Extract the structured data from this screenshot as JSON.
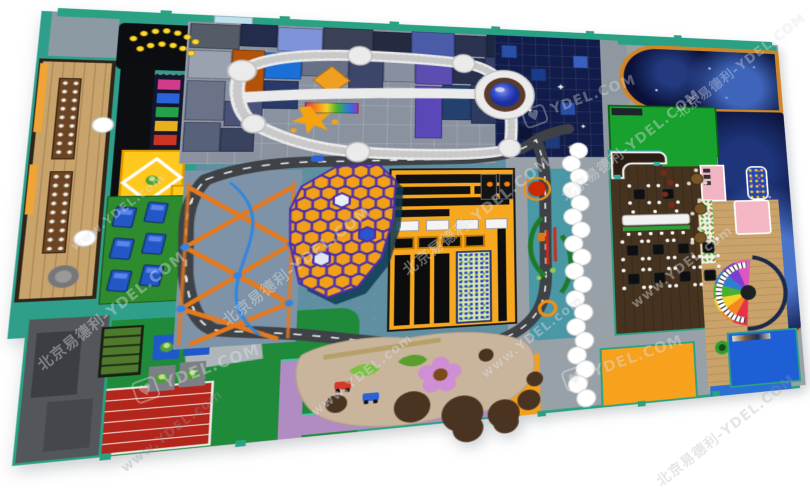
{
  "title": "indoor-playground-floorplan-render",
  "watermark": {
    "brand_cn": "北京易德利",
    "brand_site": "YDEL.COM",
    "brand_url": "www.YDEL.com",
    "combined": "北京易德利-YDEL.COM",
    "heart_glyph": "♥",
    "instances": [
      {
        "kind": "combined",
        "x": 20,
        "y": 300,
        "rot": -38,
        "size": 15,
        "opacity": 0.5,
        "tone": "light"
      },
      {
        "kind": "url",
        "x": 110,
        "y": 424,
        "rot": -38,
        "size": 13,
        "opacity": 0.55,
        "tone": "dark"
      },
      {
        "kind": "url",
        "x": 60,
        "y": 205,
        "rot": -38,
        "size": 12,
        "opacity": 0.45,
        "tone": "light"
      },
      {
        "kind": "combined",
        "x": 205,
        "y": 255,
        "rot": -38,
        "size": 15,
        "opacity": 0.5,
        "tone": "light"
      },
      {
        "kind": "url",
        "x": 300,
        "y": 368,
        "rot": -38,
        "size": 13,
        "opacity": 0.5,
        "tone": "light"
      },
      {
        "kind": "combined",
        "x": 385,
        "y": 205,
        "rot": -38,
        "size": 15,
        "opacity": 0.5,
        "tone": "light"
      },
      {
        "kind": "url",
        "x": 470,
        "y": 330,
        "rot": -38,
        "size": 13,
        "opacity": 0.5,
        "tone": "light"
      },
      {
        "kind": "combined",
        "x": 545,
        "y": 135,
        "rot": -38,
        "size": 14,
        "opacity": 0.5,
        "tone": "light"
      },
      {
        "kind": "url",
        "x": 620,
        "y": 260,
        "rot": -38,
        "size": 13,
        "opacity": 0.5,
        "tone": "light"
      },
      {
        "kind": "combined",
        "x": 660,
        "y": 55,
        "rot": -38,
        "size": 13,
        "opacity": 0.45,
        "tone": "light"
      },
      {
        "kind": "combined",
        "x": 640,
        "y": 420,
        "rot": -38,
        "size": 14,
        "opacity": 0.45,
        "tone": "dark"
      },
      {
        "kind": "heart",
        "x": 130,
        "y": 360,
        "rot": -20,
        "size": 16,
        "opacity": 0.5,
        "tone": "light"
      },
      {
        "kind": "heart",
        "x": 520,
        "y": 90,
        "rot": -20,
        "size": 14,
        "opacity": 0.45,
        "tone": "light"
      },
      {
        "kind": "heart",
        "x": 560,
        "y": 350,
        "rot": -20,
        "size": 15,
        "opacity": 0.5,
        "tone": "light"
      }
    ]
  },
  "palette": {
    "teal_wall": "#2aa183",
    "teal_floor": "#2f9f8b",
    "center_floor": "#5f8fa0",
    "gray_floor": "#98a1a8",
    "wood": "#c9a36c",
    "green_field": "#1f8a3a",
    "track_red": "#b3261c",
    "stage_black": "#0b0d11",
    "arcade_navy": "#12172b",
    "mat_yellow": "#ffc81e",
    "honeycomb_orange": "#f2a019",
    "honeycomb_line": "#4c2fa8",
    "ninja_orange": "#f8a81f",
    "road_gray": "#3e4146",
    "starry_navy": "#111c4a",
    "galaxy_blue": "#0a1036",
    "galaxy_border": "#cf8627",
    "green_room": "#18a12c",
    "restaurant_floor": "#46331f",
    "pink_room": "#f2b3c0",
    "purple_walkway": "#b08cc2",
    "sand": "#c9b49c",
    "dirt": "#4b3322",
    "orange_room": "#f7a11c",
    "blue_room": "#1f5fd6",
    "cloud_white": "#ffffff",
    "kiddie_blue": "#2357c8",
    "hedge_green": "#1e7a2a"
  },
  "zones": [
    {
      "id": "dining-party-room",
      "label": "wooden dining party room"
    },
    {
      "id": "performance-stage",
      "label": "black stage with spotlights"
    },
    {
      "id": "arcade-games",
      "label": "arcade game machines"
    },
    {
      "id": "soft-play-mats",
      "label": "yellow soft play mats"
    },
    {
      "id": "kids-lounge",
      "label": "green lounge with blue kid tables"
    },
    {
      "id": "garden-planters",
      "label": "planting garden beds"
    },
    {
      "id": "play-mat-tiles",
      "label": "four creature play mats"
    },
    {
      "id": "running-track",
      "label": "red running track"
    },
    {
      "id": "entrance-corridor",
      "label": "gray entrance corridor"
    },
    {
      "id": "trampoline-park",
      "label": "trampoline mosaic park"
    },
    {
      "id": "elevated-walkway",
      "label": "white elevated walkway loop"
    },
    {
      "id": "volcano-ball-pit",
      "label": "volcano crater ball pit"
    },
    {
      "id": "climbing-honeycomb",
      "label": "honeycomb climbing structure"
    },
    {
      "id": "ropes-course",
      "label": "orange ropes course"
    },
    {
      "id": "ninja-obstacle-building",
      "label": "orange-black ninja course building"
    },
    {
      "id": "ball-pit",
      "label": "speckled ball pit"
    },
    {
      "id": "landscape-garden",
      "label": "teal garden with hedges"
    },
    {
      "id": "go-kart-track",
      "label": "go-kart road circuit"
    },
    {
      "id": "cloud-walkway",
      "label": "white cloud stepping path"
    },
    {
      "id": "starry-tile-zone",
      "label": "dark starry trampoline tiles"
    },
    {
      "id": "galaxy-ball-pool",
      "label": "galaxy themed ball pool"
    },
    {
      "id": "green-party-room",
      "label": "green party room"
    },
    {
      "id": "restaurant",
      "label": "restaurant with tables"
    },
    {
      "id": "toddler-piano-zone",
      "label": "toddler zone with rainbow piano"
    },
    {
      "id": "sand-play-area",
      "label": "sand and dirt play area"
    },
    {
      "id": "purple-walkway",
      "label": "purple walkway"
    },
    {
      "id": "orange-party-room",
      "label": "orange room"
    },
    {
      "id": "blue-media-room",
      "label": "blue media room"
    }
  ]
}
